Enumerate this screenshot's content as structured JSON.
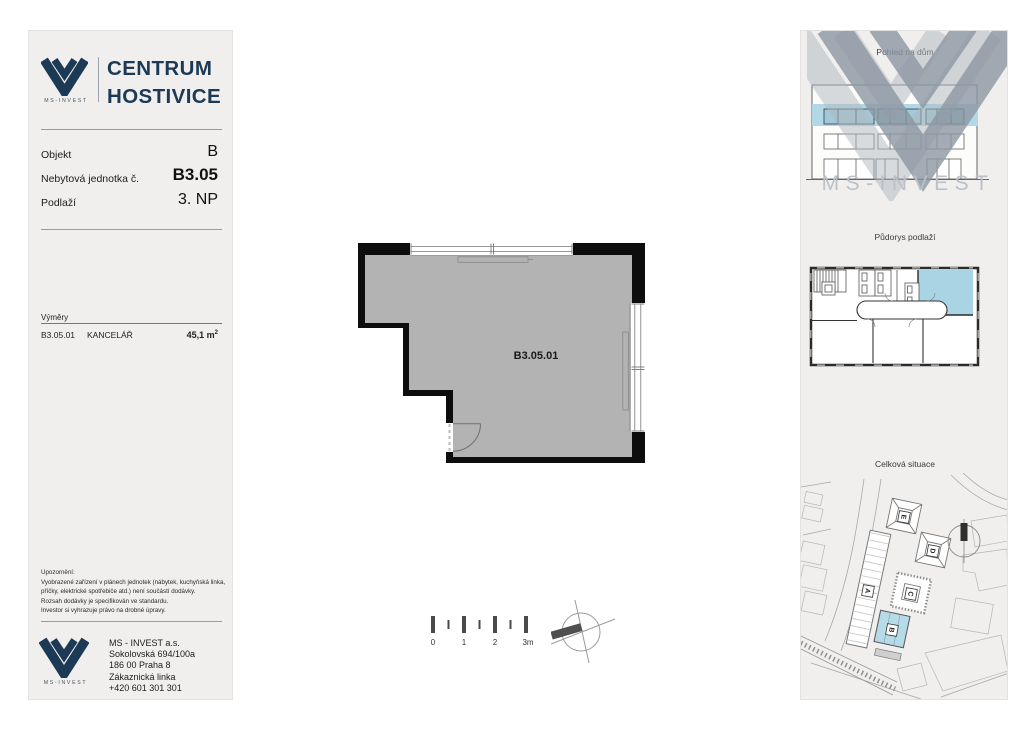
{
  "brand": {
    "name_line1": "CENTRUM",
    "name_line2": "HOSTIVICE",
    "logo_caption": "MS-INVEST"
  },
  "unit_info": {
    "rows": [
      {
        "label": "Objekt",
        "value": "B"
      },
      {
        "label": "Nebytová jednotka č.",
        "value": "B3.05"
      },
      {
        "label": "Podlaží",
        "value": "3. NP"
      }
    ]
  },
  "areas": {
    "title": "Výměry",
    "row": {
      "code": "B3.05.01",
      "name": "KANCELÁŘ",
      "area": "45,1",
      "area_unit": "m",
      "area_sup": "2"
    }
  },
  "notice": {
    "lines": [
      "Upozornění:",
      "Vyobrazené zařízení v plánech jednotek (nábytek, kuchyňská linka,",
      "příčky, elektrické spotřebiče atd.) není součástí dodávky.",
      "Rozsah dodávky je specifikován ve standardu.",
      "Investor si vyhrazuje právo na drobné úpravy."
    ]
  },
  "footer": {
    "logo_caption": "MS-INVEST",
    "company": "MS - INVEST a.s.",
    "street": "Sokolovská 694/100a",
    "city": "186 00 Praha 8",
    "phone_label": "Zákaznická linka",
    "phone": "+420 601 301 301"
  },
  "floorplan": {
    "unit_label": "B3.05.01"
  },
  "scalebar": {
    "labels": [
      "0",
      "1",
      "2",
      "3m"
    ]
  },
  "sidebar": {
    "watermark_text": "MS-INVEST",
    "section_view": {
      "title": "Pohled na dům"
    },
    "section_floor": {
      "title": "Půdorys podlaží"
    },
    "section_site": {
      "title": "Celková situace",
      "building_labels": [
        "A",
        "B",
        "C",
        "D",
        "E"
      ]
    }
  },
  "colors": {
    "navy": "#1c3a55",
    "panel_bg": "#f0efee",
    "plan_fill": "#b3b3b3",
    "wall": "#0d0d0d",
    "highlight_blue": "#aed6e4",
    "watermark_gray": "#8d98a3"
  }
}
